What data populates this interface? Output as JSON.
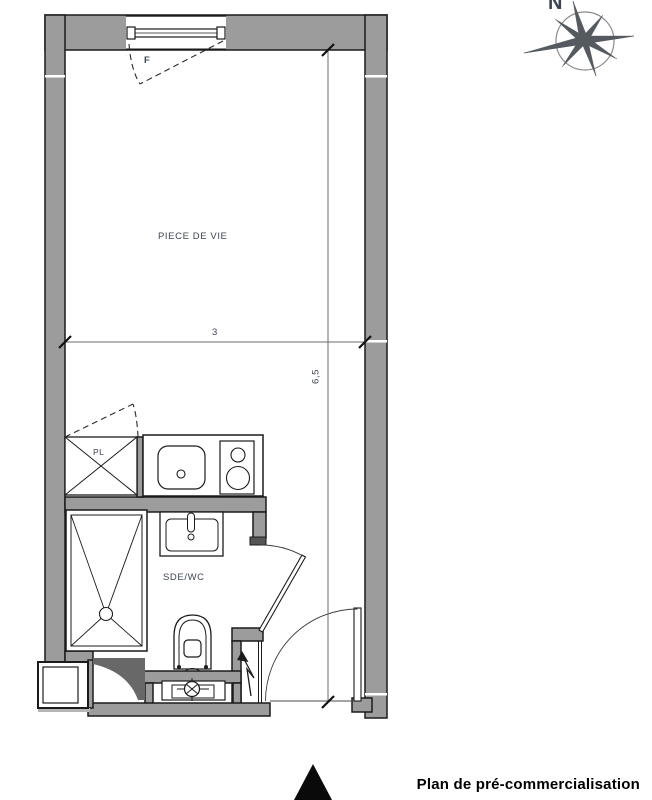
{
  "plan": {
    "title": "Plan de pré-commercialisation",
    "labels": {
      "living_room": "PIECE DE VIE",
      "bathroom": "SDE/WC",
      "closet": "PL",
      "window": "F"
    },
    "dimensions": {
      "width_m": "3",
      "height_m": "6,5"
    },
    "compass_north": "N"
  },
  "colors": {
    "wall_fill": "#9c9c9c",
    "outline": "#1b1b1b",
    "label_text": "#3d4653",
    "dim_line": "#6b6b6b",
    "compass": "#555a60",
    "title_text": "#000000"
  }
}
